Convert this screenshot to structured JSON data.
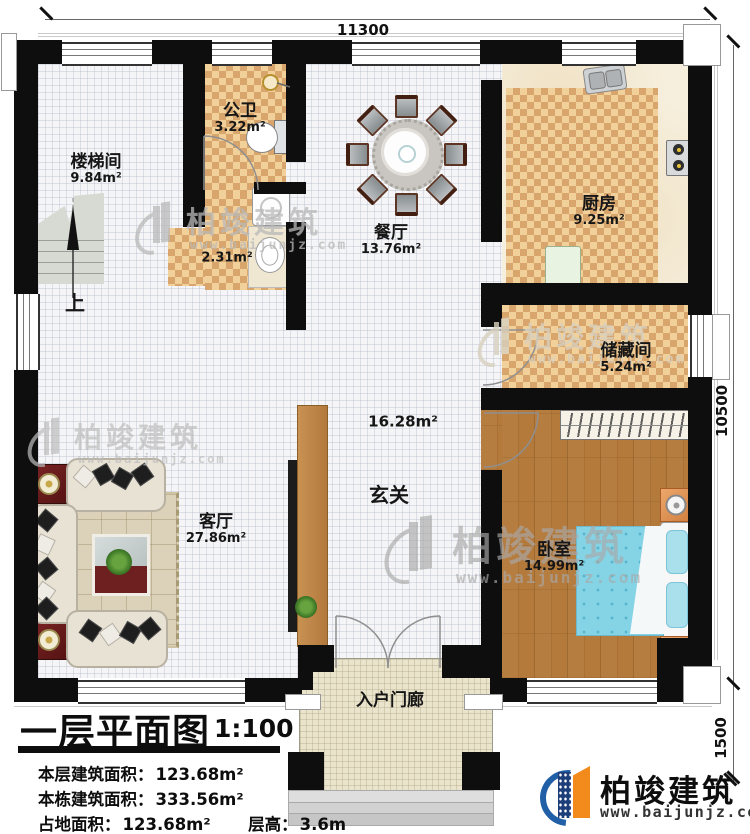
{
  "plan": {
    "dim_top": "11300",
    "dim_right_upper": "10500",
    "dim_right_lower": "1500",
    "stairs_up_label": "上",
    "rooms": {
      "stairwell": {
        "name": "楼梯间",
        "area": "9.84m²"
      },
      "bathroom": {
        "name": "公卫",
        "area": "3.22m²"
      },
      "laundry": {
        "area": "2.31m²"
      },
      "dining": {
        "name": "餐厅",
        "area": "13.76m²"
      },
      "kitchen": {
        "name": "厨房",
        "area": "9.25m²"
      },
      "storage": {
        "name": "储藏间",
        "area": "5.24m²"
      },
      "bedroom": {
        "name": "卧室",
        "area": "14.99m²"
      },
      "living": {
        "name": "客厅",
        "area": "27.86m²"
      },
      "foyer": {
        "name": "玄关",
        "area": "16.28m²"
      },
      "porch": {
        "name": "入户门廊"
      }
    }
  },
  "title_block": {
    "title": "一层平面图",
    "scale": "1:100",
    "stats": [
      {
        "label": "本层建筑面积：",
        "value": "123.68m²"
      },
      {
        "label": "本栋建筑面积：",
        "value": "333.56m²"
      },
      {
        "label": "占地面积：",
        "value": "123.68m²"
      },
      {
        "label": "层高：",
        "value": "3.6m"
      }
    ]
  },
  "branding": {
    "name": "柏竣建筑",
    "url": "www.baijunjz.com"
  },
  "watermark": {
    "name": "柏竣建筑",
    "url": "www.baijunjz.com"
  },
  "colors": {
    "wall": "#0e0e0e",
    "checker_dark": "#d8a56c",
    "checker_light": "#f2d099",
    "wood": "#b07a3e",
    "brand_blue": "#2160a6",
    "brand_orange": "#f28a1c",
    "bed_blue": "#85d4e6"
  }
}
